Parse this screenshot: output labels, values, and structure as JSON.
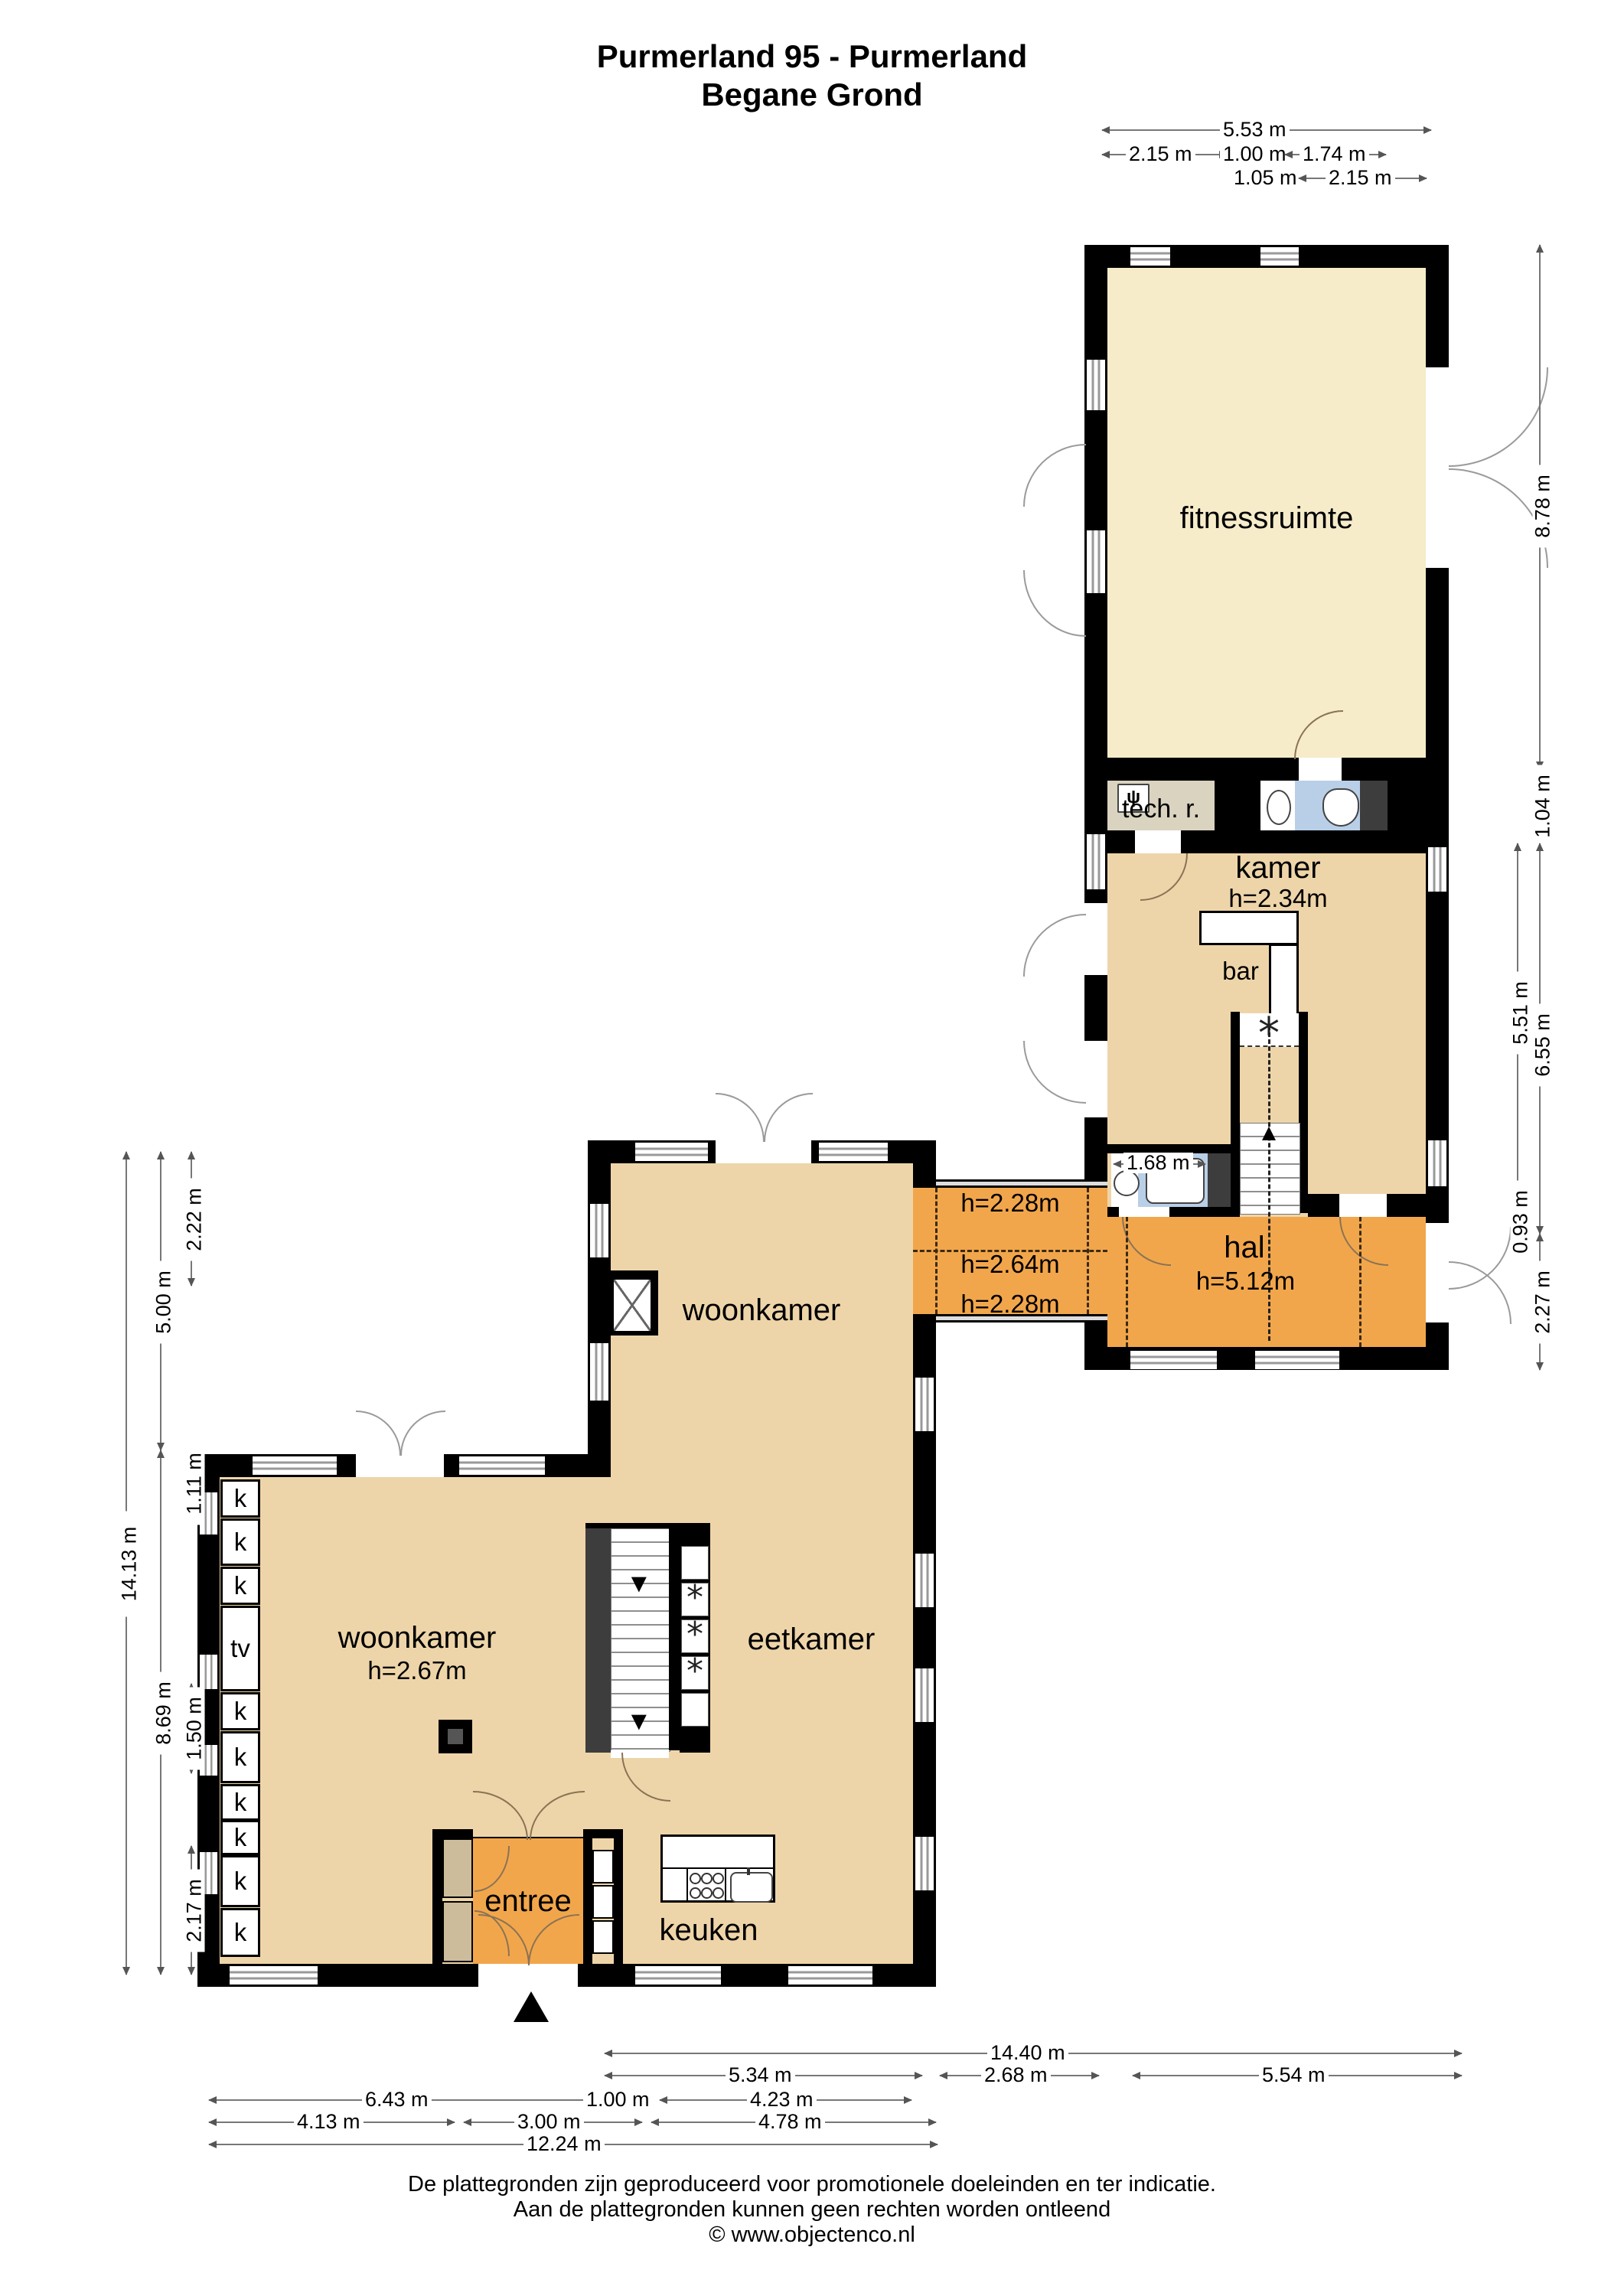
{
  "title": {
    "line1": "Purmerland 95 - Purmerland",
    "line2": "Begane Grond"
  },
  "rooms": {
    "fitnessruimte": {
      "label": "fitnessruimte"
    },
    "tech": {
      "label": "tech. r."
    },
    "kamer": {
      "label": "kamer",
      "height": "h=2.34m"
    },
    "bar": {
      "label": "bar"
    },
    "hal": {
      "label": "hal",
      "height": "h=5.12m"
    },
    "corridor": {
      "h_top": "h=2.28m",
      "h_mid": "h=2.64m",
      "h_bottom": "h=2.28m"
    },
    "woonkamer_upper": {
      "label": "woonkamer"
    },
    "woonkamer": {
      "label": "woonkamer",
      "height": "h=2.67m"
    },
    "eetkamer": {
      "label": "eetkamer"
    },
    "keuken": {
      "label": "keuken"
    },
    "entree": {
      "label": "entree"
    }
  },
  "fixtures": {
    "closet": "k",
    "tv": "tv",
    "bath_dim": "1.68 m",
    "fan_symbol": "*",
    "boiler_symbol": "ψ",
    "stair_down_arrow": "▼"
  },
  "dimensions": {
    "top": {
      "total": "5.53 m",
      "row2": [
        "2.15 m",
        "1.00 m",
        "1.74 m"
      ],
      "row3": [
        "1.05 m",
        "2.15 m"
      ]
    },
    "right": [
      "8.78 m",
      "1.04 m",
      "5.51 m",
      "6.55 m",
      "0.93 m",
      "2.27 m"
    ],
    "left": [
      "14.13 m",
      "5.00 m",
      "8.69 m",
      "2.22 m",
      "1.11 m",
      "1.50 m",
      "2.17 m"
    ],
    "bottom": {
      "row1": "14.40 m",
      "row2": [
        "5.34 m",
        "2.68 m",
        "5.54 m"
      ],
      "row3": [
        "6.43 m",
        "1.00 m",
        "4.23 m"
      ],
      "row4": [
        "4.13 m",
        "3.00 m",
        "4.78 m"
      ],
      "row5": "12.24 m"
    }
  },
  "footer": {
    "line1": "De plattegronden zijn geproduceerd voor promotionele doeleinden en ter indicatie.",
    "line2": "Aan de plattegronden kunnen geen rechten worden ontleend",
    "line3": "© www.objectenco.nl"
  },
  "colors": {
    "wall": "#000000",
    "room_cream": "#f6ecca",
    "room_tan": "#eed5a9",
    "zone_orange": "#f2a64b",
    "bath_blue": "#b9cfe7",
    "tech_gray": "#d9d3c0",
    "closet_dark": "#3d3d3d"
  }
}
